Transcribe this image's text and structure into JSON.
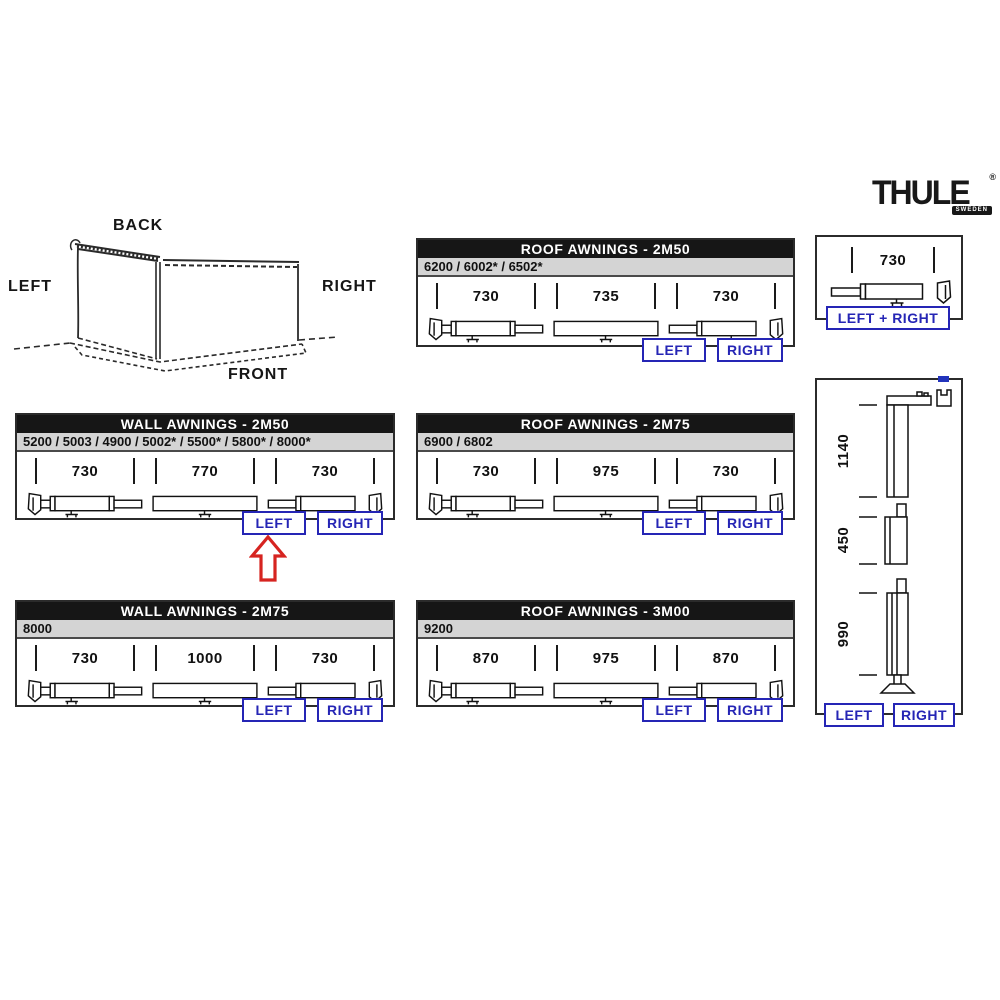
{
  "logo": {
    "brand": "THULE",
    "registered": "®",
    "tagline": "SWEDEN"
  },
  "orientation": {
    "back": "BACK",
    "left": "LEFT",
    "right": "RIGHT",
    "front": "FRONT"
  },
  "panels": {
    "roof_2m50": {
      "title": "ROOF AWNINGS - 2M50",
      "subtitle": "6200 / 6002* / 6502*",
      "dims": [
        "730",
        "735",
        "730"
      ],
      "left": "LEFT",
      "right": "RIGHT"
    },
    "single": {
      "dim": "730",
      "button": "LEFT + RIGHT"
    },
    "wall_2m50": {
      "title": "WALL AWNINGS - 2M50",
      "subtitle": "5200 / 5003 / 4900 / 5002* / 5500* / 5800* / 8000*",
      "dims": [
        "730",
        "770",
        "730"
      ],
      "left": "LEFT",
      "right": "RIGHT"
    },
    "roof_2m75": {
      "title": "ROOF AWNINGS - 2M75",
      "subtitle": "6900 / 6802",
      "dims": [
        "730",
        "975",
        "730"
      ],
      "left": "LEFT",
      "right": "RIGHT"
    },
    "wall_2m75": {
      "title": "WALL AWNINGS - 2M75",
      "subtitle": "8000",
      "dims": [
        "730",
        "1000",
        "730"
      ],
      "left": "LEFT",
      "right": "RIGHT"
    },
    "roof_3m00": {
      "title": "ROOF AWNINGS - 3M00",
      "subtitle": "9200",
      "dims": [
        "870",
        "975",
        "870"
      ],
      "left": "LEFT",
      "right": "RIGHT"
    },
    "legs": {
      "dims": [
        "1140",
        "450",
        "990"
      ],
      "left": "LEFT",
      "right": "RIGHT"
    }
  },
  "colors": {
    "accent_blue": "#2525b5",
    "arrow_red": "#d62420",
    "header_bg": "#161616",
    "subtitle_bg": "#d4d4d4"
  }
}
